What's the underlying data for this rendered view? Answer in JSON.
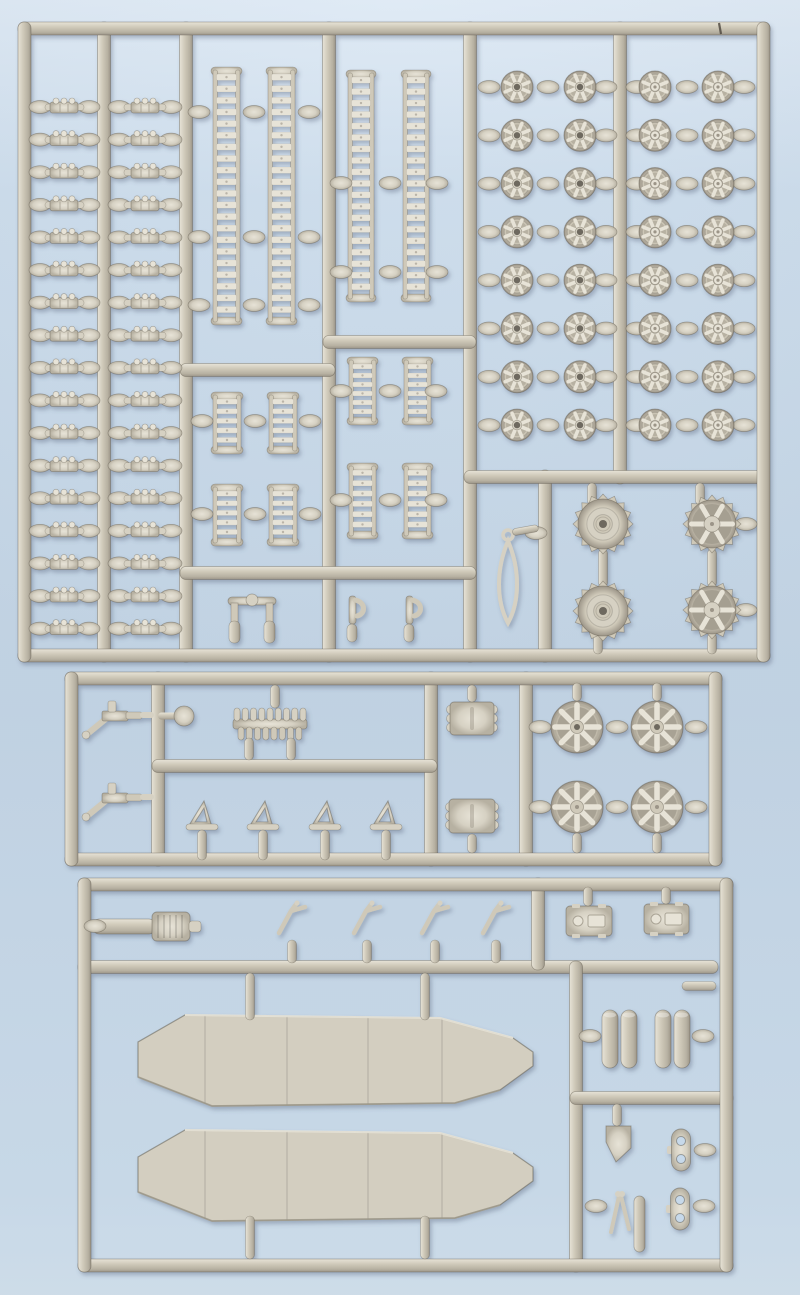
{
  "scene": {
    "width": 800,
    "height": 1295,
    "subject": "three injection-molded model kit sprues (part trees) with tank parts on a light blue surface"
  },
  "colors": {
    "bg_hole": "#c7d9ea",
    "plastic": "#cfc9b9",
    "plastic_light": "#e7e3d7",
    "plastic_mid": "#d6d1c3",
    "plastic_dim": "#b7b1a2",
    "plastic_dark": "#9c9588",
    "outline": "rgba(90,84,72,0.45)",
    "hole": "#6e695f",
    "hull": "#d3cec0",
    "hull_hi": "#e9e5d9",
    "hull_sh": "#a39d8f",
    "seam": "#4a443c",
    "shadow": "#46566e"
  },
  "sprues": [
    {
      "id": "sprue-top",
      "frame": {
        "x": 18,
        "y": 22,
        "w": 752,
        "h": 640
      },
      "rails": [
        {
          "o": "v",
          "x": 104,
          "y1": 22,
          "y2": 662
        },
        {
          "o": "v",
          "x": 186,
          "y1": 22,
          "y2": 662
        },
        {
          "o": "v",
          "x": 329,
          "y1": 22,
          "y2": 662
        },
        {
          "o": "v",
          "x": 470,
          "y1": 22,
          "y2": 662
        },
        {
          "o": "v",
          "x": 620,
          "y1": 22,
          "y2": 484
        },
        {
          "o": "v",
          "x": 545,
          "y1": 470,
          "y2": 662
        },
        {
          "o": "h",
          "y": 370,
          "x1": 180,
          "x2": 335
        },
        {
          "o": "h",
          "y": 342,
          "x1": 323,
          "x2": 476
        },
        {
          "o": "h",
          "y": 573,
          "x1": 180,
          "x2": 476
        },
        {
          "o": "h",
          "y": 477,
          "x1": 464,
          "x2": 767
        }
      ],
      "parts": [
        {
          "type": "link_column",
          "x1": 31,
          "x2": 98,
          "cx": 64,
          "y0": 107,
          "dy": 32.6,
          "n": 17
        },
        {
          "type": "link_column",
          "x1": 110,
          "x2": 180,
          "cx": 145,
          "y0": 107,
          "dy": 32.6,
          "n": 17
        },
        {
          "type": "track_run",
          "x": 213,
          "y": 70,
          "w": 27,
          "h": 252,
          "n": 21
        },
        {
          "type": "track_run",
          "x": 268,
          "y": 70,
          "w": 27,
          "h": 252,
          "n": 21
        },
        {
          "type": "track_run",
          "x": 348,
          "y": 73,
          "w": 26,
          "h": 226,
          "n": 19
        },
        {
          "type": "track_run",
          "x": 403,
          "y": 73,
          "w": 26,
          "h": 226,
          "n": 19
        },
        {
          "type": "track_run",
          "x": 213,
          "y": 395,
          "w": 28,
          "h": 56,
          "n": 5
        },
        {
          "type": "track_run",
          "x": 269,
          "y": 395,
          "w": 28,
          "h": 56,
          "n": 5
        },
        {
          "type": "track_run",
          "x": 213,
          "y": 487,
          "w": 28,
          "h": 56,
          "n": 5
        },
        {
          "type": "track_run",
          "x": 269,
          "y": 487,
          "w": 28,
          "h": 56,
          "n": 5
        },
        {
          "type": "track_run",
          "x": 349,
          "y": 360,
          "w": 27,
          "h": 62,
          "n": 6
        },
        {
          "type": "track_run",
          "x": 404,
          "y": 360,
          "w": 27,
          "h": 62,
          "n": 6
        },
        {
          "type": "track_run",
          "x": 349,
          "y": 466,
          "w": 27,
          "h": 70,
          "n": 6
        },
        {
          "type": "track_run",
          "x": 404,
          "y": 466,
          "w": 27,
          "h": 70,
          "n": 6
        },
        {
          "type": "gates",
          "pts": [
            [
              199,
              112
            ],
            [
              254,
              112
            ],
            [
              309,
              112
            ],
            [
              199,
              237
            ],
            [
              254,
              237
            ],
            [
              309,
              237
            ],
            [
              199,
              305
            ],
            [
              254,
              305
            ],
            [
              309,
              305
            ],
            [
              341,
              183
            ],
            [
              390,
              183
            ],
            [
              437,
              183
            ],
            [
              341,
              272
            ],
            [
              390,
              272
            ],
            [
              437,
              272
            ],
            [
              202,
              421
            ],
            [
              255,
              421
            ],
            [
              310,
              421
            ],
            [
              202,
              514
            ],
            [
              255,
              514
            ],
            [
              310,
              514
            ],
            [
              341,
              391
            ],
            [
              390,
              391
            ],
            [
              436,
              391
            ],
            [
              341,
              500
            ],
            [
              390,
              500
            ],
            [
              436,
              500
            ],
            [
              746,
              524
            ],
            [
              746,
              610
            ],
            [
              536,
              533
            ]
          ]
        },
        {
          "type": "stubs_v",
          "pts": [
            [
              592,
              483,
              505
            ],
            [
              700,
              483,
              505
            ],
            [
              603,
              549,
              587
            ],
            [
              712,
              549,
              587
            ],
            [
              598,
              633,
              654
            ],
            [
              712,
              633,
              654
            ]
          ]
        },
        {
          "type": "shackle",
          "cx": 252,
          "cy": 615
        },
        {
          "type": "hook",
          "cx": 352,
          "cy": 618
        },
        {
          "type": "hook",
          "cx": 409,
          "cy": 618
        },
        {
          "type": "wheel_grid",
          "cols": [
            {
              "x": 517,
              "hub": "hole"
            },
            {
              "x": 580,
              "hub": "hole"
            },
            {
              "x": 655,
              "hub": "cap"
            },
            {
              "x": 718,
              "hub": "cap"
            }
          ],
          "y0": 87,
          "dy": 48.3,
          "rows": 8,
          "r": 16,
          "gates": [
            489,
            548,
            606,
            637,
            687,
            744
          ]
        },
        {
          "type": "sprocket_dish",
          "cx": 603,
          "cy": 524,
          "r": 26
        },
        {
          "type": "sprocket_dish",
          "cx": 603,
          "cy": 611,
          "r": 26
        },
        {
          "type": "sprocket_spoked",
          "cx": 712,
          "cy": 524,
          "r": 25
        },
        {
          "type": "sprocket_spoked",
          "cx": 712,
          "cy": 610,
          "r": 25
        },
        {
          "type": "cable",
          "x": 508,
          "y": 535
        },
        {
          "type": "seam",
          "x": 719,
          "y1": 23,
          "y2": 34
        }
      ]
    },
    {
      "id": "sprue-middle",
      "frame": {
        "x": 65,
        "y": 672,
        "w": 657,
        "h": 194
      },
      "rails": [
        {
          "o": "v",
          "x": 158,
          "y1": 672,
          "y2": 866
        },
        {
          "o": "v",
          "x": 431,
          "y1": 672,
          "y2": 866
        },
        {
          "o": "v",
          "x": 526,
          "y1": 672,
          "y2": 866
        },
        {
          "o": "h",
          "y": 766,
          "x1": 152,
          "x2": 437
        }
      ],
      "parts": [
        {
          "type": "mg_gun",
          "x": 100,
          "y": 705
        },
        {
          "type": "mg_gun",
          "x": 100,
          "y": 787
        },
        {
          "type": "knob",
          "cx": 184,
          "cy": 716
        },
        {
          "type": "tooth_strip",
          "x": 233,
          "y": 708,
          "w": 74,
          "h": 32
        },
        {
          "type": "tri_bracket",
          "cx": 203,
          "cy": 816
        },
        {
          "type": "tri_bracket",
          "cx": 264,
          "cy": 816
        },
        {
          "type": "tri_bracket",
          "cx": 326,
          "cy": 816
        },
        {
          "type": "tri_bracket",
          "cx": 387,
          "cy": 816
        },
        {
          "type": "block_bumps",
          "x": 450,
          "y": 702,
          "w": 44,
          "h": 33
        },
        {
          "type": "block_bumps",
          "x": 449,
          "y": 799,
          "w": 46,
          "h": 34
        },
        {
          "type": "spoked_wheel",
          "cx": 577,
          "cy": 727,
          "r": 26,
          "hub": "hole"
        },
        {
          "type": "spoked_wheel",
          "cx": 657,
          "cy": 727,
          "r": 26,
          "hub": "hole"
        },
        {
          "type": "spoked_wheel",
          "cx": 577,
          "cy": 807,
          "r": 26,
          "hub": "cap"
        },
        {
          "type": "spoked_wheel",
          "cx": 657,
          "cy": 807,
          "r": 26,
          "hub": "cap"
        },
        {
          "type": "gates",
          "pts": [
            [
              540,
              727
            ],
            [
              617,
              727
            ],
            [
              696,
              727
            ],
            [
              540,
              807
            ],
            [
              617,
              807
            ],
            [
              696,
              807
            ]
          ]
        },
        {
          "type": "stubs_v",
          "pts": [
            [
              275,
              685,
              708
            ],
            [
              472,
              685,
              702
            ],
            [
              472,
              834,
              853
            ],
            [
              577,
              683,
              701
            ],
            [
              657,
              683,
              701
            ],
            [
              577,
              833,
              853
            ],
            [
              657,
              833,
              853
            ]
          ]
        }
      ]
    },
    {
      "id": "sprue-bottom",
      "frame": {
        "x": 78,
        "y": 878,
        "w": 655,
        "h": 394
      },
      "rails": [
        {
          "o": "h",
          "y": 967,
          "x1": 78,
          "x2": 718
        },
        {
          "o": "v",
          "x": 538,
          "y1": 878,
          "y2": 970
        },
        {
          "o": "v",
          "x": 576,
          "y1": 961,
          "y2": 1272
        },
        {
          "o": "h",
          "y": 1098,
          "x1": 570,
          "x2": 733
        }
      ],
      "parts": [
        {
          "type": "muffler",
          "x": 92,
          "y": 912
        },
        {
          "type": "tool",
          "cx": 293,
          "cy": 919,
          "post": [
            940,
            963
          ]
        },
        {
          "type": "tool",
          "cx": 368,
          "cy": 919,
          "post": [
            940,
            963
          ]
        },
        {
          "type": "tool",
          "cx": 436,
          "cy": 919,
          "post": [
            940,
            963
          ]
        },
        {
          "type": "tool",
          "cx": 497,
          "cy": 919,
          "post": [
            940,
            963
          ]
        },
        {
          "type": "hatch",
          "x": 566,
          "y": 906,
          "w": 46,
          "h": 30
        },
        {
          "type": "hatch",
          "x": 644,
          "y": 904,
          "w": 45,
          "h": 30
        },
        {
          "type": "hull",
          "dy": 0
        },
        {
          "type": "hull",
          "dy": 115
        },
        {
          "type": "cyl_pair",
          "x": 602,
          "y": 1010
        },
        {
          "type": "cyl_pair",
          "x": 655,
          "y": 1010
        },
        {
          "type": "wedge",
          "x": 606,
          "y": 1126
        },
        {
          "type": "hole_bracket",
          "cx": 681,
          "cy": 1150
        },
        {
          "type": "v_tool",
          "cx": 622,
          "cy": 1212
        },
        {
          "type": "hole_bracket",
          "cx": 680,
          "cy": 1209
        },
        {
          "type": "gates",
          "pts": [
            [
              95,
              926
            ],
            [
              590,
              1036
            ],
            [
              703,
              1036
            ],
            [
              705,
              1150
            ],
            [
              596,
              1206
            ],
            [
              704,
              1206
            ]
          ]
        },
        {
          "type": "stubs_v",
          "pts": [
            [
              588,
              887,
              906
            ],
            [
              666,
              887,
              904
            ],
            [
              617,
              1104,
              1126
            ],
            [
              250,
              973,
              1020
            ],
            [
              425,
              973,
              1020
            ],
            [
              250,
              1216,
              1259
            ],
            [
              425,
              1216,
              1259
            ]
          ]
        },
        {
          "type": "stubs_h",
          "pts": [
            [
              986,
              682,
              716
            ]
          ]
        }
      ]
    }
  ],
  "hull_shape": {
    "poly": [
      [
        185,
        1015
      ],
      [
        440,
        1018
      ],
      [
        513,
        1038
      ],
      [
        533,
        1052
      ],
      [
        533,
        1066
      ],
      [
        500,
        1090
      ],
      [
        455,
        1103
      ],
      [
        212,
        1106
      ],
      [
        138,
        1077
      ],
      [
        138,
        1042
      ]
    ],
    "panel_lines_x": [
      205,
      287,
      368,
      442
    ],
    "top_edge": [
      [
        185,
        1015
      ],
      [
        440,
        1018
      ],
      [
        513,
        1038
      ]
    ],
    "bottom_edge": [
      [
        138,
        1077
      ],
      [
        212,
        1106
      ],
      [
        455,
        1103
      ],
      [
        500,
        1090
      ]
    ]
  }
}
